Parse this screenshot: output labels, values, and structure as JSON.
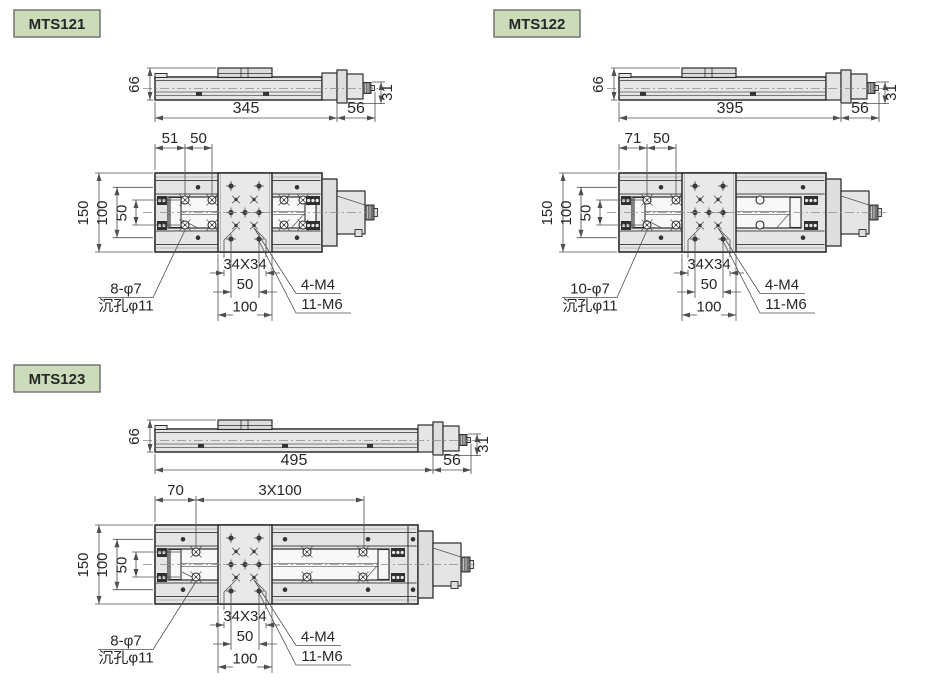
{
  "colors": {
    "background": "#ffffff",
    "badge_fill": "#ccdcba",
    "badge_border": "#757575",
    "line": "#2d2d2d",
    "dim": "#4f4f4f",
    "text": "#262626",
    "centerline": "#8a8a8a",
    "hole": "#3d3d3d",
    "fill_body": "#e5e5e5",
    "fill_plate": "#e9e9e9",
    "fill_slot": "#f8f8f8",
    "fill_flange": "#dedede",
    "fill_carriage": "#dcdcdc",
    "knob": "#707070"
  },
  "figures": [
    {
      "model": "MTS121",
      "side_view": {
        "height": "66",
        "length": "345",
        "end_length": "56",
        "axis_height": "31"
      },
      "top_view": {
        "overall_width": "150",
        "row_spacing": "100",
        "slot_width": "50",
        "top_dims": [
          "51",
          "50"
        ],
        "grid_dim": "34X34",
        "pitch": "50",
        "plate_width": "100",
        "callout_left": [
          "8-φ7",
          "沉孔φ11"
        ],
        "callout_right": [
          "4-M4",
          "11-M6"
        ]
      }
    },
    {
      "model": "MTS122",
      "side_view": {
        "height": "66",
        "length": "395",
        "end_length": "56",
        "axis_height": "31"
      },
      "top_view": {
        "overall_width": "150",
        "row_spacing": "100",
        "slot_width": "50",
        "top_dims": [
          "71",
          "50"
        ],
        "grid_dim": "34X34",
        "pitch": "50",
        "plate_width": "100",
        "callout_left": [
          "10-φ7",
          "沉孔φ11"
        ],
        "callout_right": [
          "4-M4",
          "11-M6"
        ]
      }
    },
    {
      "model": "MTS123",
      "side_view": {
        "height": "66",
        "length": "495",
        "end_length": "56",
        "axis_height": "31"
      },
      "top_view": {
        "overall_width": "150",
        "row_spacing": "100",
        "slot_width": "50",
        "top_dims": [
          "70",
          "3X100"
        ],
        "grid_dim": "34X34",
        "pitch": "50",
        "plate_width": "100",
        "callout_left": [
          "8-φ7",
          "沉孔φ11"
        ],
        "callout_right": [
          "4-M4",
          "11-M6"
        ]
      }
    }
  ]
}
